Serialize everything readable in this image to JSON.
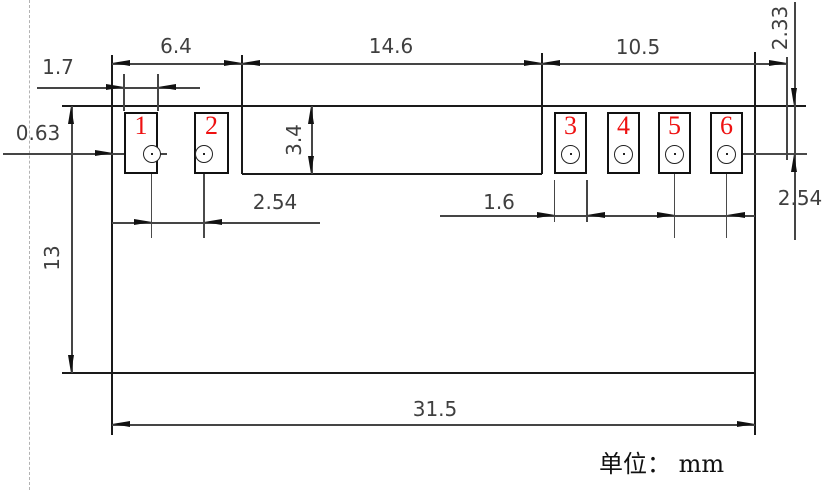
{
  "drawing": {
    "unit_note": "单位： mm",
    "pad_number_color": "#ee1111",
    "outline_color": "#1a1a1a",
    "dim_color": "#454545",
    "dashed_color": "#b3b3b3",
    "background": "#ffffff"
  },
  "pads": [
    {
      "id": "1",
      "x": 124,
      "y": 112,
      "w": 34,
      "h": 62,
      "hole_cx": 151.5,
      "hole_cy": 154,
      "hole_r": 9
    },
    {
      "id": "2",
      "x": 194,
      "y": 112,
      "w": 35,
      "h": 62,
      "hole_cx": 204,
      "hole_cy": 154,
      "hole_r": 9
    },
    {
      "id": "3",
      "x": 554,
      "y": 112,
      "w": 33,
      "h": 62,
      "hole_cx": 570.5,
      "hole_cy": 154,
      "hole_r": 9.5
    },
    {
      "id": "4",
      "x": 607,
      "y": 112,
      "w": 33,
      "h": 62,
      "hole_cx": 623.5,
      "hole_cy": 154,
      "hole_r": 9.5
    },
    {
      "id": "5",
      "x": 658,
      "y": 112,
      "w": 33,
      "h": 62,
      "hole_cx": 674.5,
      "hole_cy": 154,
      "hole_r": 9.5
    },
    {
      "id": "6",
      "x": 710,
      "y": 112,
      "w": 33,
      "h": 62,
      "hole_cx": 726.5,
      "hole_cy": 154,
      "hole_r": 9.5
    }
  ],
  "dimensions": [
    {
      "label": "6.4",
      "x": 176,
      "y": 46,
      "rot": false
    },
    {
      "label": "14.6",
      "x": 391,
      "y": 46,
      "rot": false
    },
    {
      "label": "10.5",
      "x": 638,
      "y": 47,
      "rot": false
    },
    {
      "label": "1.7",
      "x": 58,
      "y": 67,
      "rot": false
    },
    {
      "label": "0.63",
      "x": 38,
      "y": 133,
      "rot": false
    },
    {
      "label": "3.4",
      "x": 294,
      "y": 140,
      "rot": true
    },
    {
      "label": "2.33",
      "x": 780,
      "y": 28,
      "rot": true
    },
    {
      "label": "13",
      "x": 52,
      "y": 258,
      "rot": true
    },
    {
      "label": "2.54",
      "x": 275,
      "y": 202,
      "rot": false
    },
    {
      "label": "1.6",
      "x": 499,
      "y": 202,
      "rot": false
    },
    {
      "label": "2.54",
      "x": 800,
      "y": 198,
      "rot": false
    },
    {
      "label": "31.5",
      "x": 435,
      "y": 409,
      "rot": false
    }
  ],
  "lines": [
    {
      "x1": 30,
      "y1": 0,
      "x2": 30,
      "y2": 490,
      "k": "dashed"
    },
    {
      "x1": 62,
      "y1": 106,
      "x2": 806,
      "y2": 106,
      "k": "outline"
    },
    {
      "x1": 112,
      "y1": 55,
      "x2": 112,
      "y2": 435,
      "k": "outline"
    },
    {
      "x1": 755,
      "y1": 52,
      "x2": 755,
      "y2": 435,
      "k": "outline"
    },
    {
      "x1": 62,
      "y1": 373,
      "x2": 755,
      "y2": 373,
      "k": "outline"
    },
    {
      "x1": 242,
      "y1": 55,
      "x2": 242,
      "y2": 174,
      "k": "outline"
    },
    {
      "x1": 542,
      "y1": 53,
      "x2": 542,
      "y2": 174,
      "k": "outline"
    },
    {
      "x1": 242,
      "y1": 174,
      "x2": 542,
      "y2": 174,
      "k": "outline"
    },
    {
      "x1": 112,
      "y1": 64,
      "x2": 787,
      "y2": 64,
      "k": "dim"
    },
    {
      "x1": 37,
      "y1": 88,
      "x2": 200,
      "y2": 88,
      "k": "dim"
    },
    {
      "x1": 124,
      "y1": 74,
      "x2": 124,
      "y2": 111,
      "k": "dim"
    },
    {
      "x1": 158,
      "y1": 74,
      "x2": 158,
      "y2": 111,
      "k": "dim"
    },
    {
      "x1": 3,
      "y1": 154,
      "x2": 167,
      "y2": 154,
      "k": "dim"
    },
    {
      "x1": 112,
      "y1": 223,
      "x2": 320,
      "y2": 223,
      "k": "dim"
    },
    {
      "x1": 151.5,
      "y1": 148,
      "x2": 151.5,
      "y2": 238,
      "k": "center"
    },
    {
      "x1": 204,
      "y1": 148,
      "x2": 204,
      "y2": 238,
      "k": "center"
    },
    {
      "x1": 72,
      "y1": 106,
      "x2": 72,
      "y2": 373,
      "k": "dim"
    },
    {
      "x1": 112,
      "y1": 425,
      "x2": 755,
      "y2": 425,
      "k": "dim"
    },
    {
      "x1": 440,
      "y1": 216,
      "x2": 755,
      "y2": 216,
      "k": "dim"
    },
    {
      "x1": 554.5,
      "y1": 180,
      "x2": 554.5,
      "y2": 222,
      "k": "dim"
    },
    {
      "x1": 587,
      "y1": 180,
      "x2": 587,
      "y2": 222,
      "k": "dim"
    },
    {
      "x1": 674.5,
      "y1": 148,
      "x2": 674.5,
      "y2": 238,
      "k": "center"
    },
    {
      "x1": 726.5,
      "y1": 148,
      "x2": 726.5,
      "y2": 238,
      "k": "center"
    },
    {
      "x1": 726.5,
      "y1": 154,
      "x2": 807,
      "y2": 154,
      "k": "center"
    },
    {
      "x1": 787,
      "y1": 57,
      "x2": 787,
      "y2": 160,
      "k": "dim"
    },
    {
      "x1": 795,
      "y1": 2,
      "x2": 795,
      "y2": 240,
      "k": "dim"
    },
    {
      "x1": 312,
      "y1": 106,
      "x2": 312,
      "y2": 174,
      "k": "dim"
    }
  ],
  "arrows": [
    {
      "x": 112,
      "y": 64,
      "dir": "left"
    },
    {
      "x": 242,
      "y": 64,
      "dir": "right"
    },
    {
      "x": 242,
      "y": 64,
      "dir": "left"
    },
    {
      "x": 542,
      "y": 64,
      "dir": "right"
    },
    {
      "x": 542,
      "y": 64,
      "dir": "left"
    },
    {
      "x": 787,
      "y": 64,
      "dir": "right"
    },
    {
      "x": 124,
      "y": 88,
      "dir": "right"
    },
    {
      "x": 158,
      "y": 88,
      "dir": "left"
    },
    {
      "x": 113,
      "y": 154,
      "dir": "right"
    },
    {
      "x": 145,
      "y": 154,
      "dir": "right"
    },
    {
      "x": 312,
      "y": 106,
      "dir": "up"
    },
    {
      "x": 312,
      "y": 174,
      "dir": "down"
    },
    {
      "x": 72,
      "y": 106,
      "dir": "up"
    },
    {
      "x": 72,
      "y": 373,
      "dir": "down"
    },
    {
      "x": 151.5,
      "y": 223,
      "dir": "right"
    },
    {
      "x": 204,
      "y": 223,
      "dir": "left"
    },
    {
      "x": 554.5,
      "y": 216,
      "dir": "right"
    },
    {
      "x": 587,
      "y": 216,
      "dir": "left"
    },
    {
      "x": 674.5,
      "y": 216,
      "dir": "right"
    },
    {
      "x": 726.5,
      "y": 216,
      "dir": "left"
    },
    {
      "x": 795,
      "y": 106,
      "dir": "down"
    },
    {
      "x": 795,
      "y": 154,
      "dir": "up"
    },
    {
      "x": 112,
      "y": 425,
      "dir": "left"
    },
    {
      "x": 755,
      "y": 425,
      "dir": "right"
    }
  ]
}
